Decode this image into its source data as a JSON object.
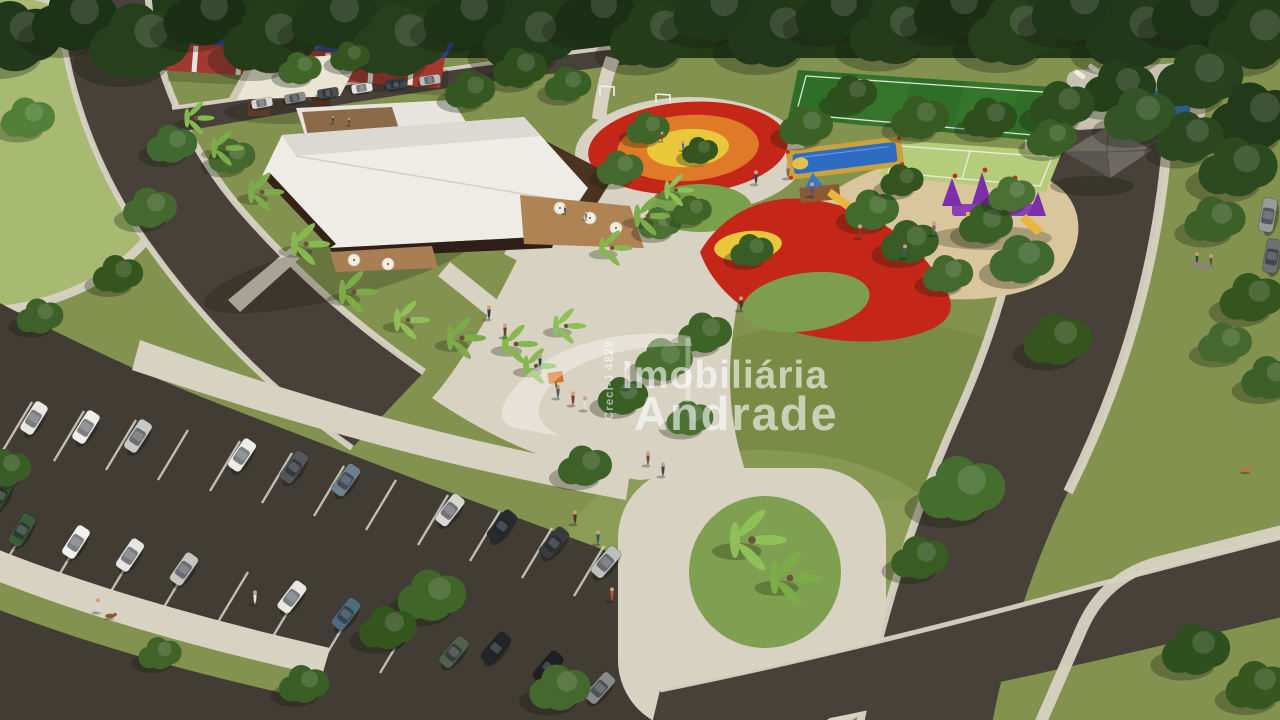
{
  "image": {
    "type": "aerial-architectural-render",
    "description": "Aerial 3D rendering of a residential development leisure park: clubhouse with white roof and wooden deck, colorful playgrounds, splash pad, sports courts, swimming pool, gazebo, curved roads and a large parking lot with parked cars, surrounded by trees and palm trees",
    "width_px": 1280,
    "height_px": 720
  },
  "watermark": {
    "brand_line1": "Imobiliária",
    "brand_line2": "Andrade",
    "registration": "Creci-J 4828",
    "color": "#ffffff"
  },
  "scene": {
    "features": [
      "forest backdrop",
      "left lawn field with curved sidewalk",
      "blue-roofed building with red and white striped wall",
      "open pavilion with cream flat roof",
      "clubhouse with large white roof, rooftop terrace and wooden deck with umbrellas",
      "palm tree rows",
      "concentric red-orange-yellow rubber playground circle",
      "red shade playground area with yellow circle and green mound",
      "blue splash pad with yellow frame",
      "wooden playset with yellow slide",
      "purple castle playset on sand",
      "soccer field",
      "multi-sport court with white markings",
      "swimming pool with loungers",
      "gazebo with gray hip roof",
      "curved access road with parallel parked cars",
      "large parking lot with angled stalls and parked cars",
      "pedestrian walkways with people",
      "palm island at street intersection",
      "people walking dogs",
      "orange park sign",
      "bench with seated people"
    ],
    "palette": {
      "grass_base": "#83934f",
      "grass_light": "#9db268",
      "grass_dark": "#5f7439",
      "forest": "#223a18",
      "road": "#474139",
      "road_dark": "#413c34",
      "sidewalk": "#d8d2c3",
      "sand": "#d9c69d",
      "clubhouse_roof": "#efece7",
      "clubhouse_wall": "#4b3322",
      "deck_wood": "#b08355",
      "playground_red": "#c42718",
      "playground_orange": "#df7b28",
      "playground_yellow": "#eac63a",
      "splash_blue": "#2e6cc4",
      "pool_blue": "#3579c8",
      "court_green": "#b5cd7a",
      "field_green": "#2f6e27",
      "purple_playset": "#7b2fa8",
      "blue_roof": "#2e3f96",
      "red_wall": "#a23830",
      "watermark_white": "#ffffff"
    }
  }
}
